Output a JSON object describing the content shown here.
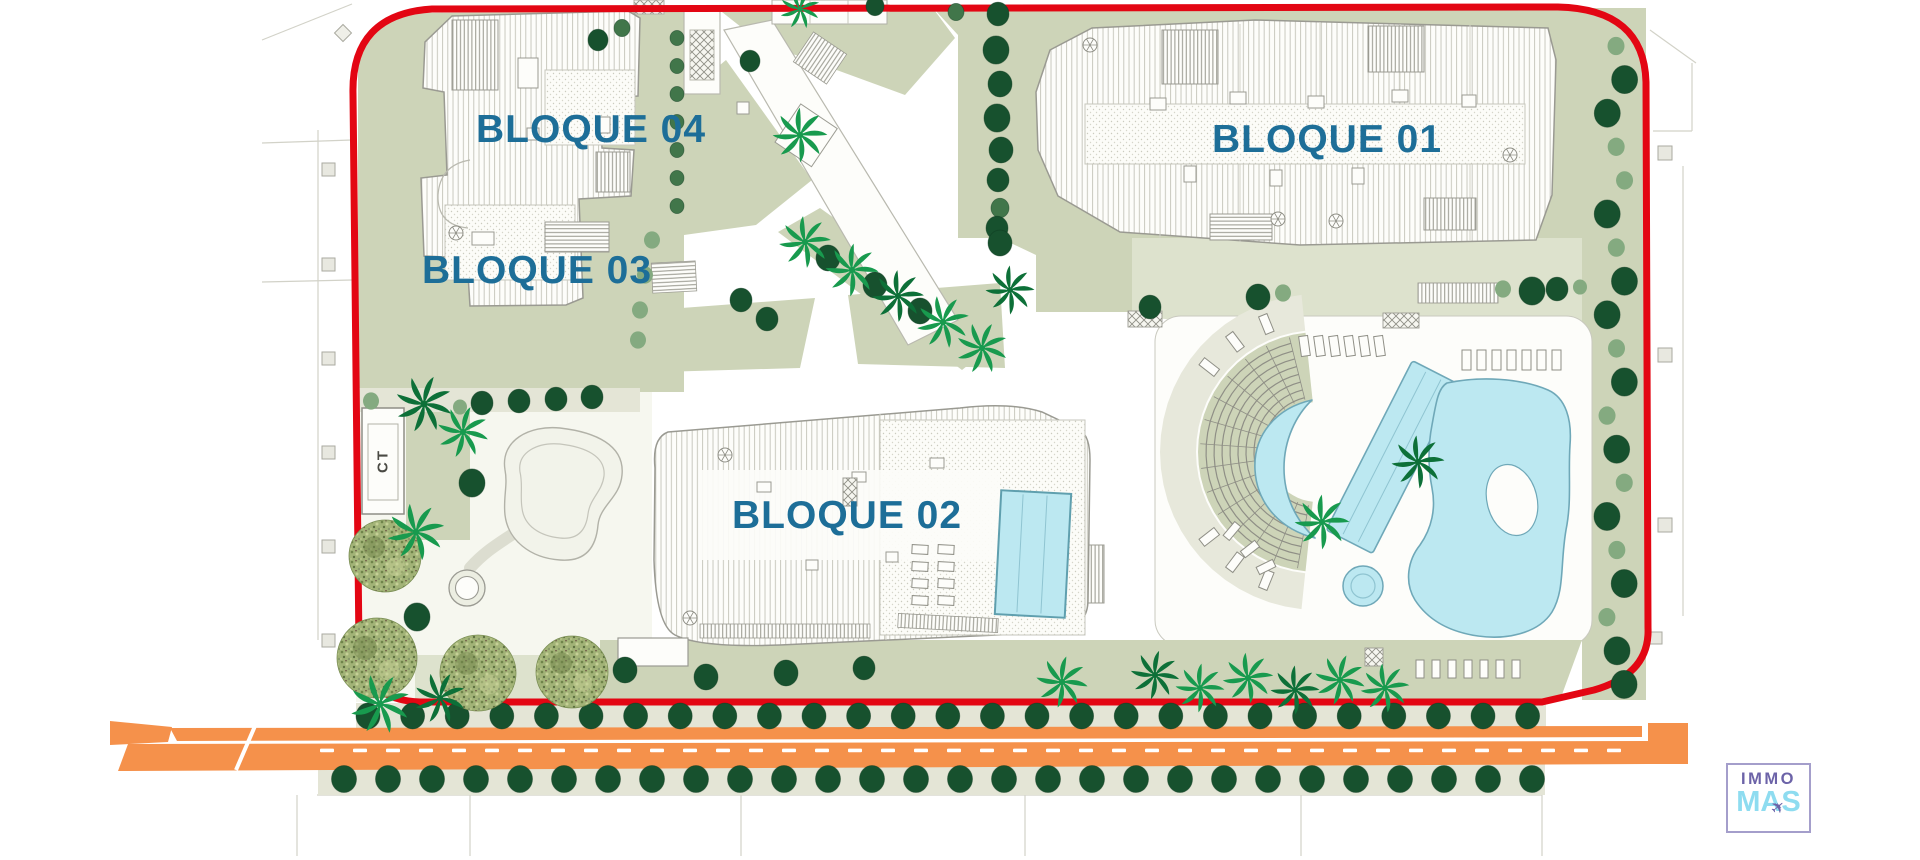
{
  "plan": {
    "block_labels": [
      {
        "id": "bloque-01",
        "text": "BLOQUE 01"
      },
      {
        "id": "bloque-02",
        "text": "BLOQUE 02"
      },
      {
        "id": "bloque-03",
        "text": "BLOQUE 03"
      },
      {
        "id": "bloque-04",
        "text": "BLOQUE 04"
      }
    ],
    "ct_label": "CT"
  },
  "logo": {
    "line1": "IMMO",
    "line2": "MAS",
    "plane_glyph": "✈"
  },
  "icons": {
    "logo_plane": "airplane-icon",
    "round_tree": "tree-icon",
    "palm_tree": "palm-tree-icon",
    "olive_tree": "olive-tree-icon"
  },
  "palette": {
    "boundary_red": "#e30613",
    "road_orange": "#f5914b",
    "pool_cyan": "#bce8f1",
    "pool_stroke": "#6fa8b8",
    "sage": "#cdd4b8",
    "sage_light": "#dde2cd",
    "beige": "#e4e5d6",
    "tree_dark": "#17512e",
    "tree_medium": "#41764a",
    "tree_light": "#84aa80",
    "palm_green": "#189a4e",
    "palm_dark": "#0d7038",
    "olive_green": "#a2b377",
    "label_blue": "#1d6e98",
    "logo_purple": "#6c63a8",
    "logo_cyan": "#8edcf0",
    "logo_border": "#a49ecb",
    "line_gray": "#9c9c93",
    "line_light": "#c6c6bc"
  }
}
